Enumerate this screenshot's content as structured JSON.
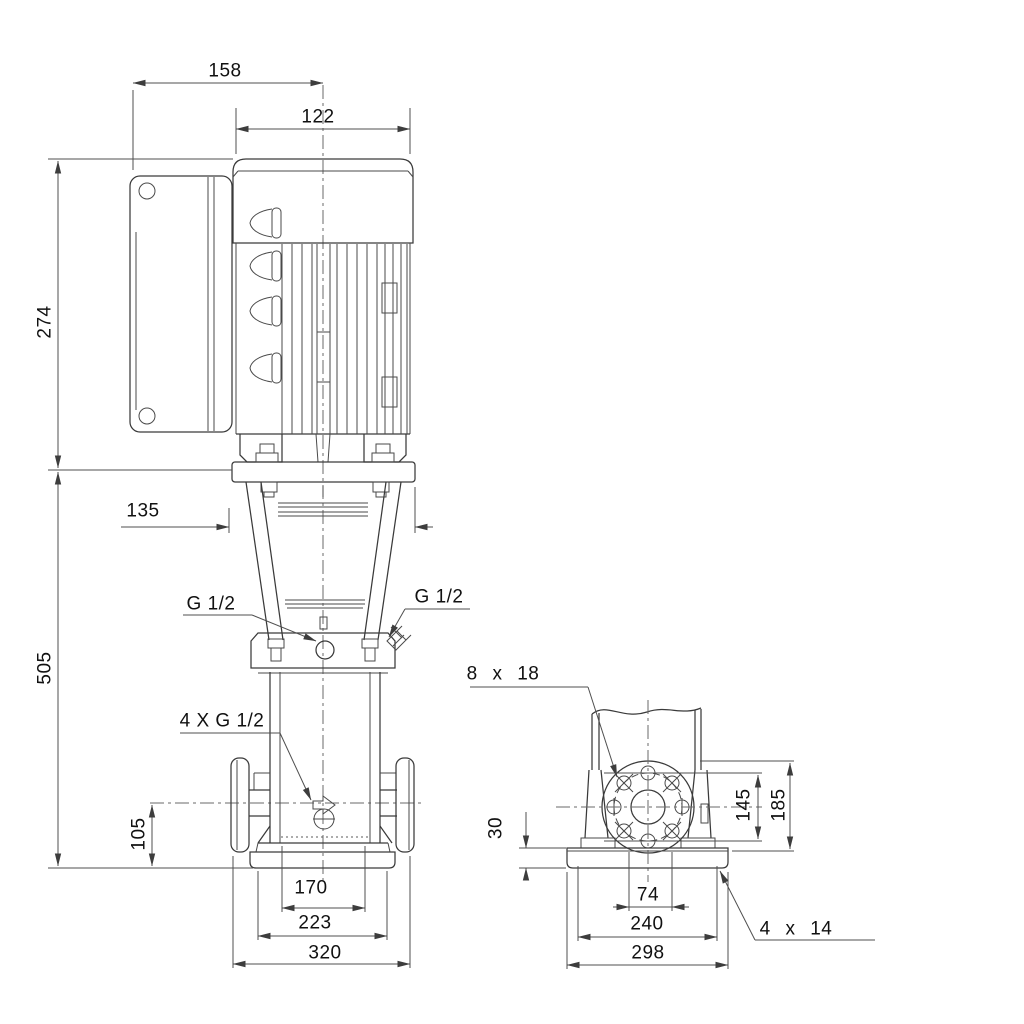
{
  "drawing_type": "pump-outline-dimensional-drawing",
  "front": {
    "d158": "158",
    "d122": "122",
    "d274": "274",
    "d505": "505",
    "d135": "135",
    "d105": "105",
    "d170": "170",
    "d223": "223",
    "d320": "320",
    "g12_left": "G 1/2",
    "g12_right": "G 1/2",
    "g4xg12": "4 X G 1/2"
  },
  "side": {
    "d8x18": "8 x 18",
    "d145": "145",
    "d185": "185",
    "d30": "30",
    "d74": "74",
    "d240": "240",
    "d298": "298",
    "d4x14": "4 x 14"
  },
  "colors": {
    "background": "#ffffff",
    "line": "#3a3a3a",
    "dimension": "#4f4f4f",
    "text": "#111111"
  }
}
